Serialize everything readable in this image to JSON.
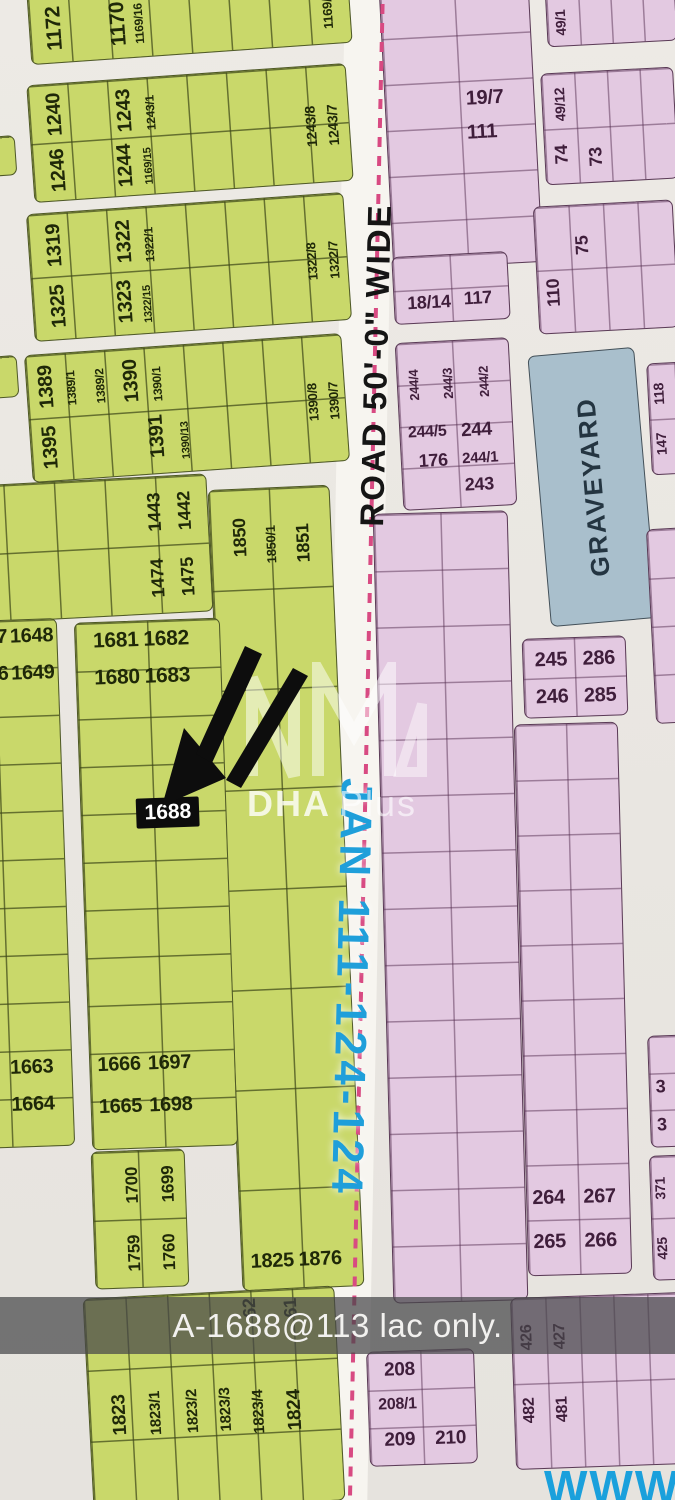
{
  "road": {
    "label": "ROAD 50'-0\" WIDE",
    "route_label": "JAN 111-124-124",
    "centerline_color": "#d84a82"
  },
  "watermark": {
    "logo": "dha-plus-logo",
    "brand_bold": "DHA",
    "brand_light": "Plus"
  },
  "caption": {
    "text": "A-1688@113 lac only."
  },
  "footer": {
    "website": "WWW."
  },
  "colors": {
    "green_block": "#c9d86a",
    "pink_block": "#e3c9e1",
    "graveyard_block": "#a9bfcc",
    "road_centerline": "#d84a82",
    "route_text": "#1f9fda",
    "website_text": "#1aa0dc",
    "highlight_box": "#0c0c0c"
  },
  "blocks": [
    {
      "id": "g-1169",
      "cls": "g",
      "x": 28,
      "y": -34,
      "w": 322,
      "h": 88,
      "rot": -4,
      "cols": 8,
      "rows": 1,
      "labels": [
        {
          "t": "1172",
          "x": 7.5,
          "y": 60,
          "fs": 21,
          "v": 1
        },
        {
          "t": "1170",
          "x": 27.5,
          "y": 60,
          "fs": 21,
          "v": 1
        },
        {
          "t": "1169/16",
          "x": 34,
          "y": 62,
          "fs": 12,
          "v": 1
        },
        {
          "t": "1169/9",
          "x": 93,
          "y": 62,
          "fs": 13,
          "v": 1
        }
      ]
    },
    {
      "id": "g-1240",
      "cls": "g",
      "x": 30,
      "y": 74,
      "w": 320,
      "h": 118,
      "rot": -4,
      "cols": 8,
      "rows": 2,
      "labels": [
        {
          "t": "1240",
          "x": 8,
          "y": 26,
          "fs": 20,
          "v": 1
        },
        {
          "t": "1246",
          "x": 8,
          "y": 74,
          "fs": 20,
          "v": 1
        },
        {
          "t": "1243",
          "x": 30,
          "y": 27,
          "fs": 20,
          "v": 1
        },
        {
          "t": "1243/1",
          "x": 38,
          "y": 30,
          "fs": 12,
          "v": 1
        },
        {
          "t": "1244",
          "x": 29,
          "y": 74,
          "fs": 20,
          "v": 1
        },
        {
          "t": "1169/15",
          "x": 36.5,
          "y": 76,
          "fs": 11,
          "v": 1
        },
        {
          "t": "1243/8",
          "x": 88,
          "y": 52,
          "fs": 14,
          "v": 1
        },
        {
          "t": "1243/7",
          "x": 95,
          "y": 52,
          "fs": 14,
          "v": 1
        }
      ]
    },
    {
      "id": "g-1319",
      "cls": "g",
      "x": 30,
      "y": 203,
      "w": 318,
      "h": 128,
      "rot": -4,
      "cols": 8,
      "rows": 2,
      "labels": [
        {
          "t": "1319",
          "x": 8,
          "y": 25,
          "fs": 20,
          "v": 1
        },
        {
          "t": "1322",
          "x": 30,
          "y": 26,
          "fs": 20,
          "v": 1
        },
        {
          "t": "1322/1",
          "x": 38,
          "y": 30,
          "fs": 12,
          "v": 1
        },
        {
          "t": "1325",
          "x": 8,
          "y": 74,
          "fs": 20,
          "v": 1
        },
        {
          "t": "1323",
          "x": 29,
          "y": 74,
          "fs": 20,
          "v": 1
        },
        {
          "t": "1322/15",
          "x": 36.5,
          "y": 77,
          "fs": 11,
          "v": 1
        },
        {
          "t": "1322/8",
          "x": 89,
          "y": 52,
          "fs": 13,
          "v": 1
        },
        {
          "t": "1322/7",
          "x": 96,
          "y": 52,
          "fs": 13,
          "v": 1
        }
      ]
    },
    {
      "id": "g-1389",
      "cls": "g",
      "x": 28,
      "y": 344,
      "w": 318,
      "h": 128,
      "rot": -4,
      "cols": 8,
      "rows": 2,
      "labels": [
        {
          "t": "1389",
          "x": 6,
          "y": 25,
          "fs": 20,
          "v": 1
        },
        {
          "t": "1389/1",
          "x": 14,
          "y": 28,
          "fs": 12,
          "v": 1
        },
        {
          "t": "1389/2",
          "x": 23,
          "y": 28,
          "fs": 12,
          "v": 1
        },
        {
          "t": "1390",
          "x": 33,
          "y": 25,
          "fs": 20,
          "v": 1
        },
        {
          "t": "1390/1",
          "x": 41,
          "y": 29,
          "fs": 12,
          "v": 1
        },
        {
          "t": "1395",
          "x": 6,
          "y": 74,
          "fs": 20,
          "v": 1
        },
        {
          "t": "1391",
          "x": 40,
          "y": 71,
          "fs": 20,
          "v": 1
        },
        {
          "t": "1390/13",
          "x": 49,
          "y": 75,
          "fs": 11,
          "v": 1
        },
        {
          "t": "1390/8",
          "x": 90,
          "y": 52,
          "fs": 13,
          "v": 1
        },
        {
          "t": "1390/7",
          "x": 96.5,
          "y": 52,
          "fs": 13,
          "v": 1
        }
      ]
    },
    {
      "id": "g-sliver1",
      "cls": "g",
      "x": -12,
      "y": 136,
      "w": 28,
      "h": 40,
      "rot": -4,
      "cols": 1,
      "rows": 1,
      "labels": []
    },
    {
      "id": "g-sliver2",
      "cls": "g",
      "x": -14,
      "y": 356,
      "w": 32,
      "h": 42,
      "rot": -4,
      "cols": 1,
      "rows": 1,
      "labels": []
    },
    {
      "id": "g-1474",
      "cls": "g",
      "x": -45,
      "y": 480,
      "w": 255,
      "h": 138,
      "rot": -3,
      "cols": 5,
      "rows": 2,
      "labels": [
        {
          "t": "1443",
          "x": 79,
          "y": 26,
          "fs": 18,
          "v": 1
        },
        {
          "t": "1442",
          "x": 91,
          "y": 26,
          "fs": 18,
          "v": 1
        },
        {
          "t": "1474",
          "x": 79,
          "y": 74,
          "fs": 18,
          "v": 1
        },
        {
          "t": "1475",
          "x": 91,
          "y": 74,
          "fs": 18,
          "v": 1
        }
      ]
    },
    {
      "id": "g-1850",
      "cls": "g",
      "x": 225,
      "y": 487,
      "w": 122,
      "h": 802,
      "rot": -2.5,
      "cols": 2,
      "rows": 8,
      "labels": [
        {
          "t": "1850",
          "x": 24,
          "y": 6,
          "fs": 18,
          "v": 1
        },
        {
          "t": "1850/1",
          "x": 50,
          "y": 7,
          "fs": 13,
          "v": 1
        },
        {
          "t": "1851",
          "x": 77,
          "y": 7,
          "fs": 18,
          "v": 1
        },
        {
          "t": "1825",
          "x": 25,
          "y": 96.5,
          "fs": 20
        },
        {
          "t": "1876",
          "x": 65,
          "y": 96.5,
          "fs": 20
        }
      ]
    },
    {
      "id": "g-1648",
      "cls": "g",
      "x": -60,
      "y": 620,
      "w": 126,
      "h": 528,
      "rot": -2,
      "cols": 2,
      "rows": 11,
      "labels": [
        {
          "t": "7",
          "x": 56,
          "y": 3,
          "fs": 20
        },
        {
          "t": "1648",
          "x": 80,
          "y": 3,
          "fs": 20
        },
        {
          "t": "6",
          "x": 56,
          "y": 10,
          "fs": 20
        },
        {
          "t": "1649",
          "x": 80,
          "y": 10,
          "fs": 20
        },
        {
          "t": "1663",
          "x": 68,
          "y": 85,
          "fs": 20
        },
        {
          "t": "1664",
          "x": 68,
          "y": 92,
          "fs": 20
        }
      ]
    },
    {
      "id": "g-1681",
      "cls": "g",
      "x": 83,
      "y": 620,
      "w": 146,
      "h": 528,
      "rot": -2,
      "cols": 2,
      "rows": 11,
      "labels": [
        {
          "t": "1681",
          "x": 28,
          "y": 3.5,
          "fs": 21
        },
        {
          "t": "1682",
          "x": 63,
          "y": 3.5,
          "fs": 21
        },
        {
          "t": "1680",
          "x": 28,
          "y": 10.5,
          "fs": 21
        },
        {
          "t": "1683",
          "x": 63,
          "y": 10.5,
          "fs": 21
        },
        {
          "t": "1688",
          "x": 60,
          "y": 36.5,
          "fs": 21,
          "box": 1
        },
        {
          "t": "1666",
          "x": 20,
          "y": 84,
          "fs": 20
        },
        {
          "t": "1697",
          "x": 55,
          "y": 84,
          "fs": 20
        },
        {
          "t": "1665",
          "x": 20,
          "y": 92,
          "fs": 20
        },
        {
          "t": "1698",
          "x": 55,
          "y": 92,
          "fs": 20
        }
      ]
    },
    {
      "id": "g-1759",
      "cls": "g",
      "x": 93,
      "y": 1150,
      "w": 94,
      "h": 138,
      "rot": -2,
      "cols": 2,
      "rows": 2,
      "labels": [
        {
          "t": "1700",
          "x": 42,
          "y": 25,
          "fs": 17,
          "v": 1
        },
        {
          "t": "1699",
          "x": 82,
          "y": 25,
          "fs": 17,
          "v": 1
        },
        {
          "t": "1759",
          "x": 42,
          "y": 75,
          "fs": 17,
          "v": 1
        },
        {
          "t": "1760",
          "x": 80,
          "y": 75,
          "fs": 17,
          "v": 1
        }
      ]
    },
    {
      "id": "g-1823",
      "cls": "g",
      "x": 88,
      "y": 1292,
      "w": 252,
      "h": 215,
      "rot": -3,
      "cols": 6,
      "rows": 3,
      "labels": [
        {
          "t": "62",
          "x": 66,
          "y": 8,
          "fs": 18,
          "v": 1
        },
        {
          "t": "61",
          "x": 82.5,
          "y": 9,
          "fs": 18,
          "v": 1
        },
        {
          "t": "1823",
          "x": 12,
          "y": 55,
          "fs": 19,
          "v": 1
        },
        {
          "t": "1823/1",
          "x": 26.5,
          "y": 55,
          "fs": 15,
          "v": 1
        },
        {
          "t": "1823/2",
          "x": 41,
          "y": 55,
          "fs": 15,
          "v": 1
        },
        {
          "t": "1823/3",
          "x": 54.5,
          "y": 55,
          "fs": 15,
          "v": 1
        },
        {
          "t": "1823/4",
          "x": 67.5,
          "y": 57,
          "fs": 15,
          "v": 1
        },
        {
          "t": "1824",
          "x": 82,
          "y": 57,
          "fs": 19,
          "v": 1
        }
      ]
    },
    {
      "id": "p-111",
      "cls": "p",
      "x": 386,
      "y": -12,
      "w": 150,
      "h": 278,
      "rot": -3,
      "cols": 2,
      "rows": 6,
      "labels": [
        {
          "t": "19/7",
          "x": 67,
          "y": 40,
          "fs": 20
        },
        {
          "t": "111",
          "x": 64,
          "y": 52,
          "fs": 20
        }
      ]
    },
    {
      "id": "p-117",
      "cls": "p",
      "x": 393,
      "y": 254,
      "w": 116,
      "h": 68,
      "rot": -3,
      "cols": 2,
      "rows": 2,
      "labels": [
        {
          "t": "18/14",
          "x": 30,
          "y": 70,
          "fs": 18
        },
        {
          "t": "117",
          "x": 73,
          "y": 67,
          "fs": 18
        }
      ]
    },
    {
      "id": "p-244",
      "cls": "p",
      "x": 399,
      "y": 340,
      "w": 114,
      "h": 168,
      "rot": -3,
      "cols": 2,
      "rows": 4,
      "labels": [
        {
          "t": "244/4",
          "x": 14,
          "y": 25,
          "fs": 13,
          "v": 1
        },
        {
          "t": "244/3",
          "x": 45,
          "y": 25,
          "fs": 13,
          "v": 1
        },
        {
          "t": "244/2",
          "x": 77,
          "y": 25,
          "fs": 13,
          "v": 1
        },
        {
          "t": "244/5",
          "x": 24,
          "y": 54,
          "fs": 16
        },
        {
          "t": "244",
          "x": 68,
          "y": 54,
          "fs": 19
        },
        {
          "t": "176",
          "x": 28,
          "y": 71,
          "fs": 18
        },
        {
          "t": "244/1",
          "x": 70,
          "y": 71,
          "fs": 15
        },
        {
          "t": "243",
          "x": 68,
          "y": 87,
          "fs": 18
        }
      ]
    },
    {
      "id": "p-mid",
      "cls": "p",
      "x": 383,
      "y": 512,
      "w": 135,
      "h": 790,
      "rot": -1.5,
      "cols": 2,
      "rows": 14,
      "labels": []
    },
    {
      "id": "p-208",
      "cls": "p",
      "x": 368,
      "y": 1350,
      "w": 108,
      "h": 115,
      "rot": -2,
      "cols": 2,
      "rows": 3,
      "labels": [
        {
          "t": "208",
          "x": 30,
          "y": 16,
          "fs": 19
        },
        {
          "t": "208/1",
          "x": 27,
          "y": 47,
          "fs": 16
        },
        {
          "t": "209",
          "x": 28,
          "y": 78,
          "fs": 19
        },
        {
          "t": "210",
          "x": 76,
          "y": 78,
          "fs": 19
        }
      ]
    },
    {
      "id": "p-49-1",
      "cls": "p",
      "x": 546,
      "y": -18,
      "w": 130,
      "h": 62,
      "rot": -3,
      "cols": 4,
      "rows": 1,
      "labels": [
        {
          "t": "49/1",
          "x": 10,
          "y": 62,
          "fs": 14,
          "v": 1
        }
      ]
    },
    {
      "id": "p-49-12",
      "cls": "p",
      "x": 543,
      "y": 70,
      "w": 133,
      "h": 112,
      "rot": -3,
      "cols": 4,
      "rows": 2,
      "labels": [
        {
          "t": "49/12",
          "x": 13,
          "y": 28,
          "fs": 14,
          "v": 1
        },
        {
          "t": "74",
          "x": 12,
          "y": 74,
          "fs": 18,
          "v": 1
        },
        {
          "t": "73",
          "x": 38,
          "y": 77,
          "fs": 18,
          "v": 1
        }
      ]
    },
    {
      "id": "p-110",
      "cls": "p",
      "x": 536,
      "y": 203,
      "w": 140,
      "h": 128,
      "rot": -3,
      "cols": 4,
      "rows": 2,
      "labels": [
        {
          "t": "75",
          "x": 33,
          "y": 32,
          "fs": 18,
          "v": 1
        },
        {
          "t": "110",
          "x": 11,
          "y": 68,
          "fs": 18,
          "v": 1
        }
      ]
    },
    {
      "id": "graveyard",
      "cls": "gy",
      "x": 539,
      "y": 351,
      "w": 107,
      "h": 272,
      "rot": -5,
      "cols": 0,
      "rows": 0,
      "labels": [
        {
          "t": "GRAVEYARD",
          "x": 50,
          "y": 50,
          "fs": 26,
          "v": 1
        }
      ]
    },
    {
      "id": "p-147",
      "cls": "p",
      "x": 649,
      "y": 362,
      "w": 56,
      "h": 112,
      "rot": -3,
      "cols": 2,
      "rows": 2,
      "labels": [
        {
          "t": "118",
          "x": 18,
          "y": 27,
          "fs": 14,
          "v": 1
        },
        {
          "t": "147",
          "x": 18,
          "y": 73,
          "fs": 14,
          "v": 1
        },
        {
          "t": "11",
          "x": 62,
          "y": 27,
          "fs": 14,
          "v": 1
        },
        {
          "t": "146",
          "x": 62,
          "y": 73,
          "fs": 14,
          "v": 1
        }
      ]
    },
    {
      "id": "p-edge-mid",
      "cls": "p",
      "x": 651,
      "y": 528,
      "w": 45,
      "h": 195,
      "rot": -3,
      "cols": 1,
      "rows": 4,
      "labels": []
    },
    {
      "id": "p-245",
      "cls": "p",
      "x": 523,
      "y": 637,
      "w": 104,
      "h": 80,
      "rot": -2,
      "cols": 2,
      "rows": 2,
      "labels": [
        {
          "t": "245",
          "x": 27,
          "y": 27,
          "fs": 20
        },
        {
          "t": "286",
          "x": 74,
          "y": 27,
          "fs": 20
        },
        {
          "t": "246",
          "x": 27,
          "y": 74,
          "fs": 20
        },
        {
          "t": "285",
          "x": 74,
          "y": 74,
          "fs": 20
        }
      ]
    },
    {
      "id": "p-264",
      "cls": "p",
      "x": 521,
      "y": 723,
      "w": 104,
      "h": 552,
      "rot": -1.5,
      "cols": 2,
      "rows": 10,
      "labels": [
        {
          "t": "264",
          "x": 21,
          "y": 86,
          "fs": 20
        },
        {
          "t": "267",
          "x": 71,
          "y": 86,
          "fs": 20
        },
        {
          "t": "265",
          "x": 21,
          "y": 94,
          "fs": 20
        },
        {
          "t": "266",
          "x": 71,
          "y": 94,
          "fs": 20
        }
      ]
    },
    {
      "id": "p-3",
      "cls": "p",
      "x": 649,
      "y": 1035,
      "w": 45,
      "h": 112,
      "rot": -2,
      "cols": 1,
      "rows": 3,
      "labels": [
        {
          "t": "3",
          "x": 25,
          "y": 45,
          "fs": 18
        },
        {
          "t": "3",
          "x": 25,
          "y": 80,
          "fs": 18
        }
      ]
    },
    {
      "id": "p-425",
      "cls": "p",
      "x": 651,
      "y": 1155,
      "w": 45,
      "h": 125,
      "rot": -2,
      "cols": 1,
      "rows": 2,
      "labels": [
        {
          "t": "371",
          "x": 22,
          "y": 26,
          "fs": 14,
          "v": 1
        },
        {
          "t": "425",
          "x": 22,
          "y": 75,
          "fs": 14,
          "v": 1
        }
      ]
    },
    {
      "id": "p-426",
      "cls": "p",
      "x": 513,
      "y": 1295,
      "w": 172,
      "h": 172,
      "rot": -2,
      "cols": 5,
      "rows": 2,
      "labels": [
        {
          "t": "426",
          "x": 9,
          "y": 23,
          "fs": 16,
          "v": 1
        },
        {
          "t": "427",
          "x": 28,
          "y": 23,
          "fs": 16,
          "v": 1
        },
        {
          "t": "482",
          "x": 9,
          "y": 66,
          "fs": 16,
          "v": 1
        },
        {
          "t": "481",
          "x": 28,
          "y": 66,
          "fs": 16,
          "v": 1
        }
      ]
    }
  ]
}
